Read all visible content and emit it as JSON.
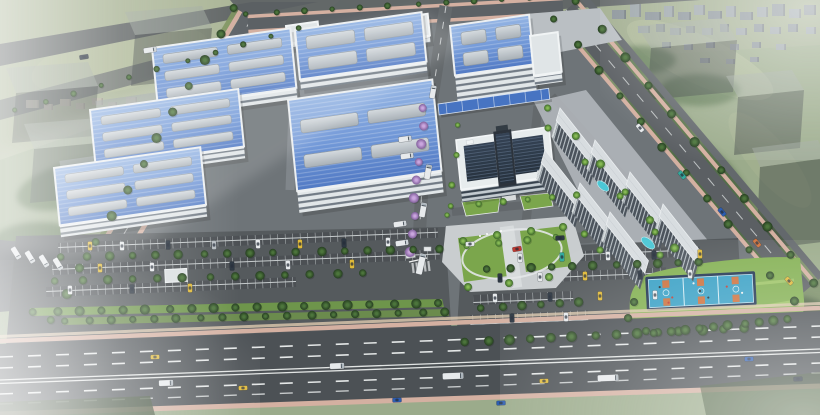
{
  "meta": {
    "width": 820,
    "height": 415,
    "title": "Industrial park aerial rendering"
  },
  "scene": {
    "description": "Bird's-eye photoreal rendering of an industrial campus: blue-roofed factory halls with skylights, central office building with dark glass atrium, white dormitory slabs, loading canopy, parking lots full of cars, basketball courts on a lawn, perimeter roads with trucks and cars, surrounded by green fields, a distant city, translucent massing blocks and white haze",
    "atmosphere": "cool gray-green cast, fog at corners"
  },
  "palette": {
    "field": "#98a887",
    "field_light": "#a9b394",
    "forest": "#4c6741",
    "asphalt_campus": "#696e73",
    "asphalt_parking": "#4e5257",
    "road": "#5a5e63",
    "highway": "#45494e",
    "sidewalk_pink": "#d5ae9f",
    "sidewalk_tan": "#dfc9ae",
    "roof_blue_light": "#93b4e6",
    "roof_blue_dark": "#4a74c4",
    "skylight": "#c9ced4",
    "facade": "#e3e7ea",
    "canopy_blue": "#3f6ec2",
    "glass_dark": "#1d2836",
    "dorm_roof": "#d9dde2",
    "dorm_facade": "#434b55",
    "court_blue": "#2f9dc5",
    "court_orange": "#cd6a34",
    "court_border": "#16294a",
    "pool_cyan": "#45c6d6",
    "lawn": "#6f9c3f",
    "lane_white": "#e6e8e9",
    "vehicles": {
      "white": "#e9ebee",
      "dark": "#242d3a",
      "yellow": "#e2b830",
      "blue": "#2456b0",
      "teal": "#2aa79b",
      "orange": "#d06a2f",
      "red": "#c03028",
      "silver": "#b6bcc2"
    }
  },
  "render": {
    "factories": [
      {
        "o": [
          286,
          26
        ],
        "w": 32,
        "d": 18,
        "fh": 6,
        "white": 1
      },
      {
        "o": [
          398,
          18
        ],
        "w": 30,
        "d": 22,
        "fh": 7,
        "white": 1
      },
      {
        "o": [
          450,
          26
        ],
        "w": 80,
        "d": 50,
        "fh": 26,
        "sk": [
          2,
          2
        ]
      },
      {
        "o": [
          530,
          36
        ],
        "w": 28,
        "d": 40,
        "fh": 10,
        "white": 1
      },
      {
        "o": [
          295,
          30
        ],
        "w": 128,
        "d": 50,
        "fh": 11,
        "sk": [
          2,
          2
        ]
      },
      {
        "o": [
          152,
          48
        ],
        "w": 140,
        "d": 60,
        "fh": 11,
        "sk": [
          2,
          3
        ]
      },
      {
        "o": [
          288,
          100
        ],
        "w": 146,
        "d": 92,
        "fh": 22,
        "sk": [
          2,
          2
        ]
      },
      {
        "o": [
          90,
          110
        ],
        "w": 150,
        "d": 58,
        "fh": 12,
        "sk": [
          2,
          3
        ]
      },
      {
        "o": [
          54,
          168
        ],
        "w": 148,
        "d": 58,
        "fh": 12,
        "sk": [
          2,
          3
        ]
      }
    ],
    "dorms": {
      "list": [
        [
          560,
          108
        ],
        [
          595,
          140
        ],
        [
          630,
          172
        ],
        [
          663,
          204
        ],
        [
          545,
          150
        ],
        [
          580,
          183
        ],
        [
          610,
          212
        ]
      ],
      "len": 62,
      "dep": 13,
      "fh": 17
    },
    "ghosts": [
      {
        "t": [
          [
            125,
            12
          ],
          [
            202,
            6
          ],
          [
            212,
            28
          ],
          [
            135,
            35
          ]
        ],
        "f": [
          [
            135,
            35
          ],
          [
            212,
            28
          ],
          [
            208,
            78
          ],
          [
            131,
            86
          ]
        ]
      },
      {
        "t": [
          [
            6,
            68
          ],
          [
            88,
            62
          ],
          [
            98,
            86
          ],
          [
            16,
            93
          ]
        ],
        "f": [
          [
            16,
            93
          ],
          [
            98,
            86
          ],
          [
            94,
            136
          ],
          [
            12,
            143
          ]
        ]
      },
      {
        "t": [
          [
            24,
            124
          ],
          [
            98,
            118
          ],
          [
            108,
            142
          ],
          [
            34,
            149
          ]
        ],
        "f": [
          [
            34,
            149
          ],
          [
            108,
            142
          ],
          [
            104,
            196
          ],
          [
            30,
            203
          ]
        ]
      },
      {
        "t": [
          [
            637,
            26
          ],
          [
            723,
            18
          ],
          [
            737,
            40
          ],
          [
            651,
            48
          ]
        ],
        "f": [
          [
            651,
            48
          ],
          [
            737,
            40
          ],
          [
            733,
            92
          ],
          [
            647,
            100
          ]
        ]
      },
      {
        "t": [
          [
            726,
            76
          ],
          [
            792,
            70
          ],
          [
            804,
            90
          ],
          [
            738,
            97
          ]
        ],
        "f": [
          [
            738,
            97
          ],
          [
            804,
            90
          ],
          [
            800,
            148
          ],
          [
            734,
            155
          ]
        ]
      },
      {
        "t": [
          [
            752,
            148
          ],
          [
            818,
            140
          ],
          [
            826,
            158
          ],
          [
            760,
            167
          ]
        ],
        "f": [
          [
            760,
            167
          ],
          [
            826,
            158
          ],
          [
            822,
            242
          ],
          [
            756,
            250
          ]
        ]
      }
    ],
    "distant": {
      "gray": [
        [
          612,
          10,
          14,
          9
        ],
        [
          630,
          4,
          11,
          13
        ],
        [
          645,
          12,
          16,
          8
        ],
        [
          664,
          6,
          10,
          11
        ],
        [
          678,
          12,
          13,
          8
        ],
        [
          694,
          5,
          11,
          10
        ],
        [
          708,
          11,
          14,
          8
        ],
        [
          726,
          6,
          10,
          11
        ],
        [
          740,
          12,
          13,
          8
        ],
        [
          757,
          7,
          11,
          10
        ],
        [
          772,
          4,
          13,
          12
        ],
        [
          789,
          9,
          12,
          9
        ],
        [
          804,
          5,
          12,
          10
        ],
        [
          638,
          26,
          12,
          7
        ],
        [
          656,
          24,
          9,
          8
        ],
        [
          670,
          28,
          11,
          7
        ],
        [
          686,
          26,
          9,
          7
        ],
        [
          702,
          28,
          11,
          7
        ],
        [
          720,
          24,
          9,
          8
        ],
        [
          736,
          28,
          11,
          7
        ],
        [
          754,
          24,
          10,
          8
        ],
        [
          770,
          27,
          11,
          7
        ],
        [
          788,
          24,
          10,
          8
        ],
        [
          806,
          27,
          10,
          7
        ],
        [
          662,
          42,
          9,
          6
        ],
        [
          684,
          44,
          9,
          6
        ],
        [
          706,
          42,
          9,
          6
        ],
        [
          730,
          44,
          9,
          6
        ],
        [
          752,
          42,
          9,
          6
        ],
        [
          776,
          44,
          10,
          6
        ],
        [
          700,
          58,
          10,
          5
        ],
        [
          726,
          59,
          9,
          5
        ],
        [
          750,
          57,
          9,
          5
        ]
      ],
      "tan": [
        [
          26,
          100,
          13,
          8
        ],
        [
          44,
          104,
          9,
          6
        ],
        [
          60,
          99,
          11,
          7
        ],
        [
          76,
          103,
          9,
          6
        ],
        [
          92,
          98,
          11,
          7
        ],
        [
          108,
          102,
          9,
          6
        ],
        [
          126,
          97,
          11,
          7
        ],
        [
          144,
          101,
          9,
          6
        ],
        [
          162,
          96,
          11,
          7
        ],
        [
          180,
          99,
          9,
          6
        ],
        [
          198,
          94,
          11,
          7
        ],
        [
          216,
          98,
          9,
          6
        ],
        [
          236,
          92,
          11,
          8
        ],
        [
          256,
          96,
          9,
          6
        ],
        [
          140,
          108,
          7,
          12
        ],
        [
          208,
          106,
          7,
          11
        ],
        [
          274,
          108,
          20,
          11
        ]
      ]
    },
    "trees": {
      "rows": [
        [
          235,
          8,
          50,
          320,
          13,
          4.5,
          "d"
        ],
        [
          247,
          14,
          559,
          -4,
          12,
          3,
          "d"
        ],
        [
          555,
          19,
          793,
          301,
          12,
          4,
          "d"
        ],
        [
          577,
          1,
          815,
          283,
          11,
          4.5,
          "d"
        ],
        [
          424,
          108,
          410,
          252,
          9,
          4.5,
          "p"
        ],
        [
          62,
          257,
          438,
          249,
          17,
          4.2,
          "d"
        ],
        [
          56,
          281,
          362,
          273,
          13,
          4.2,
          "d"
        ],
        [
          34,
          312,
          438,
          303,
          19,
          4.5,
          "d"
        ],
        [
          66,
          321,
          444,
          312,
          18,
          4,
          "d"
        ],
        [
          488,
          269,
          700,
          262,
          11,
          4.2,
          "d"
        ],
        [
          482,
          308,
          580,
          302,
          6,
          4.2,
          "d"
        ],
        [
          466,
          342,
          744,
          328,
          14,
          4.8,
          "d"
        ],
        [
          655,
          333,
          788,
          319,
          10,
          4.5,
          "d"
        ],
        [
          549,
          108,
          676,
          248,
          6,
          4,
          "b"
        ],
        [
          459,
          125,
          447,
          215,
          4,
          3,
          "b"
        ],
        [
          468,
          246,
          585,
          234,
          5,
          3.5,
          "b"
        ],
        [
          452,
          206,
          578,
          195,
          6,
          3.2,
          "b"
        ],
        [
          16,
          110,
          300,
          28,
          11,
          2.8,
          "d"
        ]
      ],
      "pts": [
        [
          463,
          241,
          4,
          "b"
        ],
        [
          497,
          235,
          4,
          "b"
        ],
        [
          531,
          231,
          4,
          "b"
        ],
        [
          563,
          227,
          4,
          "b"
        ],
        [
          468,
          287,
          4,
          "b"
        ],
        [
          509,
          283,
          4,
          "b"
        ],
        [
          549,
          277,
          4,
          "b"
        ],
        [
          548,
          128,
          3.5,
          "b"
        ],
        [
          585,
          162,
          3.5,
          "b"
        ],
        [
          620,
          196,
          3.5,
          "b"
        ],
        [
          655,
          232,
          3.5,
          "b"
        ],
        [
          600,
          250,
          3.5,
          "b"
        ],
        [
          660,
          255,
          3.5,
          "b"
        ],
        [
          634,
          302,
          4,
          "d"
        ],
        [
          628,
          318,
          4,
          "d"
        ],
        [
          646,
          331,
          4,
          "d"
        ]
      ]
    },
    "vehicles": {
      "moving": [
        [
          "car",
          155,
          357,
          -2,
          "yellow"
        ],
        [
          "truck",
          166,
          383,
          -2,
          "white"
        ],
        [
          "car",
          243,
          388,
          -2,
          "yellow"
        ],
        [
          "truck",
          337,
          366,
          -2,
          "white"
        ],
        [
          "car",
          397,
          400,
          -2,
          "blue"
        ],
        [
          "semi",
          453,
          376,
          -2,
          "white"
        ],
        [
          "car",
          544,
          381,
          -2,
          "yellow"
        ],
        [
          "semi",
          608,
          378,
          -2,
          "white"
        ],
        [
          "car",
          501,
          403,
          -2,
          "blue"
        ],
        [
          "car",
          749,
          359,
          -2,
          "blue"
        ],
        [
          "car",
          798,
          379,
          -2,
          "dark"
        ],
        [
          "car",
          682,
          175,
          50,
          "teal"
        ],
        [
          "car",
          722,
          212,
          50,
          "blue"
        ],
        [
          "car",
          757,
          243,
          50,
          "orange"
        ],
        [
          "car",
          789,
          281,
          48,
          "yellow"
        ],
        [
          "car",
          640,
          128,
          50,
          "white"
        ],
        [
          "truck",
          428,
          172,
          -80,
          "white"
        ],
        [
          "truck",
          423,
          210,
          -80,
          "white"
        ],
        [
          "semi",
          421,
          264,
          -77,
          "white"
        ],
        [
          "trailer",
          433,
          92,
          -80,
          "white"
        ],
        [
          "trailer",
          405,
          139,
          -8,
          "white"
        ],
        [
          "trailer",
          407,
          156,
          -8,
          "white"
        ],
        [
          "trailer",
          400,
          224,
          -8,
          "white"
        ],
        [
          "trailer",
          402,
          243,
          -8,
          "white"
        ],
        [
          "trailer",
          16,
          253,
          58,
          "white"
        ],
        [
          "trailer",
          30,
          257,
          58,
          "white"
        ],
        [
          "trailer",
          44,
          261,
          58,
          "white"
        ],
        [
          "trailer",
          58,
          264,
          58,
          "white"
        ],
        [
          "car",
          517,
          249,
          -10,
          "red"
        ],
        [
          "car",
          470,
          244,
          -4,
          "white"
        ],
        [
          "car",
          560,
          238,
          -4,
          "dark"
        ],
        [
          "trailer",
          150,
          50,
          -9,
          "white"
        ],
        [
          "car",
          84,
          57,
          -9,
          "dark"
        ]
      ],
      "parked_angle": 88,
      "parked": [
        [
          90,
          246,
          "yellow"
        ],
        [
          122,
          246,
          "white"
        ],
        [
          168,
          245,
          "dark"
        ],
        [
          214,
          245,
          "silver"
        ],
        [
          258,
          244,
          "white"
        ],
        [
          300,
          244,
          "yellow"
        ],
        [
          344,
          243,
          "dark"
        ],
        [
          388,
          242,
          "white"
        ],
        [
          100,
          268,
          "yellow"
        ],
        [
          152,
          267,
          "white"
        ],
        [
          232,
          266,
          "dark"
        ],
        [
          288,
          265,
          "white"
        ],
        [
          352,
          264,
          "yellow"
        ],
        [
          70,
          290,
          "white"
        ],
        [
          132,
          289,
          "dark"
        ],
        [
          190,
          288,
          "yellow"
        ],
        [
          520,
          258,
          "white"
        ],
        [
          562,
          257,
          "teal"
        ],
        [
          608,
          256,
          "white"
        ],
        [
          654,
          255,
          "dark"
        ],
        [
          700,
          254,
          "yellow"
        ],
        [
          500,
          278,
          "dark"
        ],
        [
          540,
          277,
          "white"
        ],
        [
          585,
          276,
          "yellow"
        ],
        [
          640,
          275,
          "dark"
        ],
        [
          690,
          274,
          "white"
        ],
        [
          495,
          298,
          "white"
        ],
        [
          550,
          297,
          "dark"
        ],
        [
          600,
          296,
          "yellow"
        ],
        [
          655,
          295,
          "white"
        ],
        [
          512,
          318,
          "dark"
        ],
        [
          566,
          317,
          "white"
        ]
      ]
    },
    "courts": {
      "count": 3,
      "surface": "#2f9dc5",
      "key": "#cd6a34"
    },
    "pools": [
      [
        603,
        186
      ],
      [
        648,
        243
      ]
    ]
  }
}
